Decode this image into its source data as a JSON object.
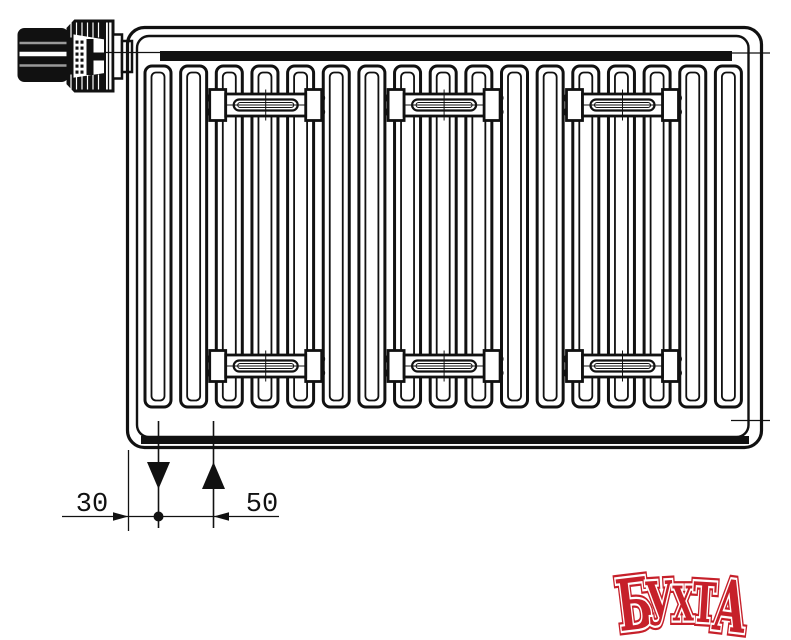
{
  "page": {
    "background_color": "#ffffff"
  },
  "drawing": {
    "description": "Panel radiator with thermostatic valve head, wall brackets and bottom connection — technical line drawing",
    "line_color": "#111111",
    "fin_count": 17,
    "bracket_column_count": 3,
    "bracket_row_count": 2,
    "valve_knob_stripe_colors": [
      "#9a9a9a",
      "#ffffff",
      "#9a9a9a"
    ]
  },
  "dimensions": {
    "wall_offset_label": "30",
    "pipe_spacing_label": "50"
  },
  "logo": {
    "text": "БУХТА",
    "fill_color": "#c6202a",
    "outline_color": "#ffffff"
  }
}
